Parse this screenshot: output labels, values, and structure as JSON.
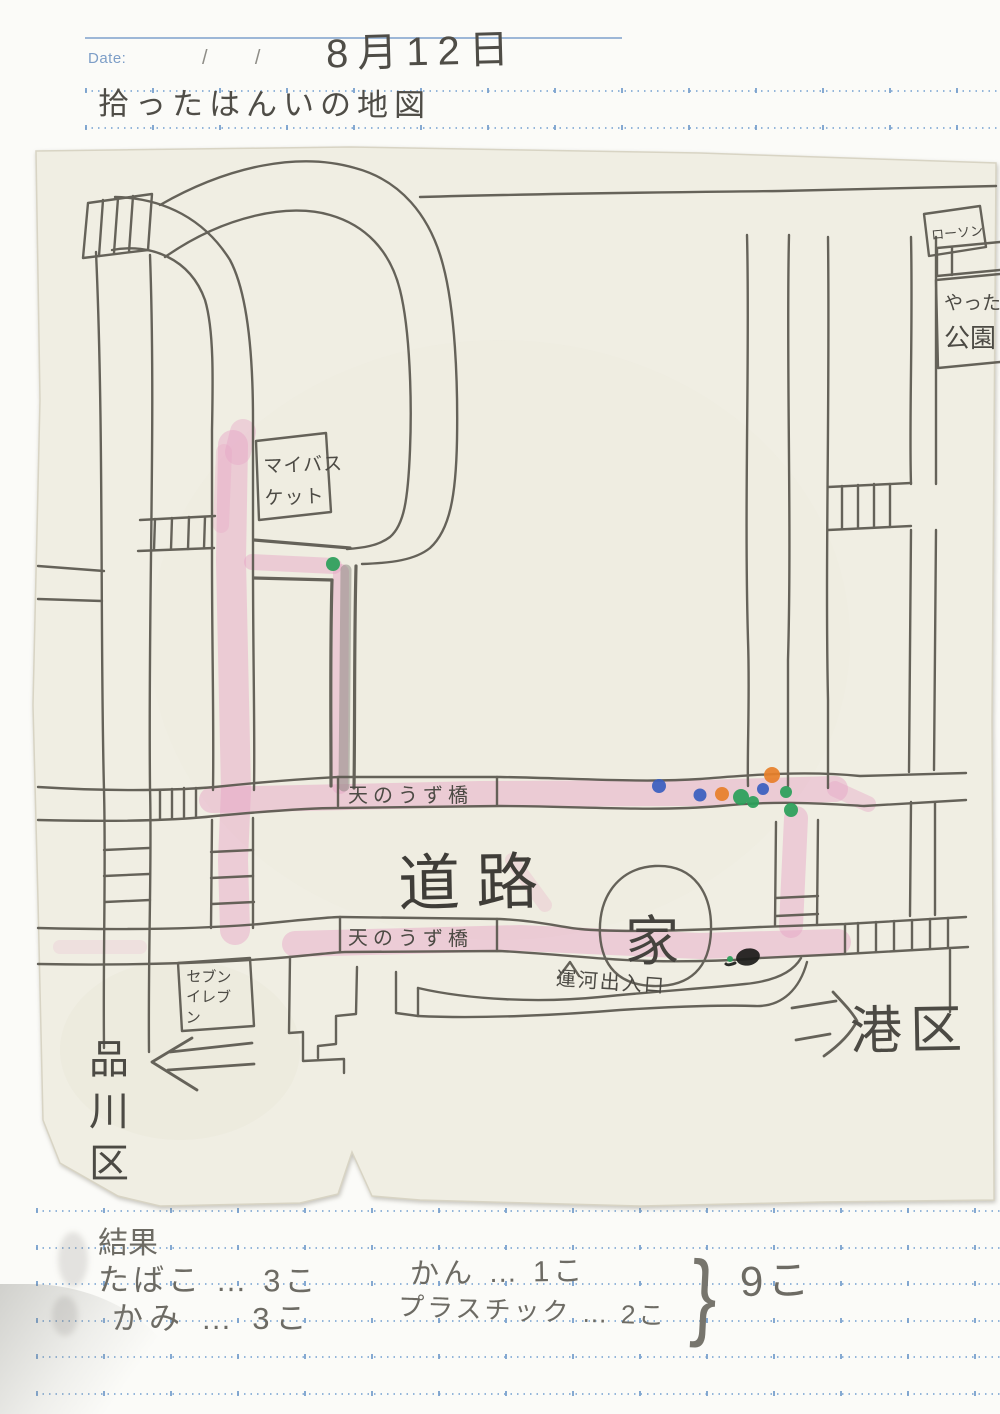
{
  "header": {
    "date_label": "Date:",
    "date_slashes": "/      /",
    "handwritten_date": "8月12日",
    "title": "拾ったはんいの地図"
  },
  "map": {
    "labels": {
      "my_basket": "マイバスケット",
      "lawson": "ローソン",
      "park_line1": "やった",
      "park_line2": "公園",
      "bridge_upper": "天のうず橋",
      "bridge_lower": "天のうず橋",
      "road": "道路",
      "house": "家",
      "canal_entrance": "運河出入口",
      "seven_eleven": "セブンイレブン",
      "shinagawa_ward": "品川区",
      "minato_ward": "港区"
    },
    "colors": {
      "pencil": "#5a574e",
      "route_pink": "#e7a2c5",
      "marker_green": "#2aa05a",
      "marker_blue": "#3a5fc0",
      "marker_orange": "#e8802a",
      "marker_black": "#1c1c1a"
    }
  },
  "results": {
    "heading": "結果",
    "items": [
      "たばこ … 3こ",
      "かみ … 3こ",
      "かん … 1こ",
      "プラスチック … 2こ"
    ],
    "brace": "}",
    "total": "9こ"
  }
}
